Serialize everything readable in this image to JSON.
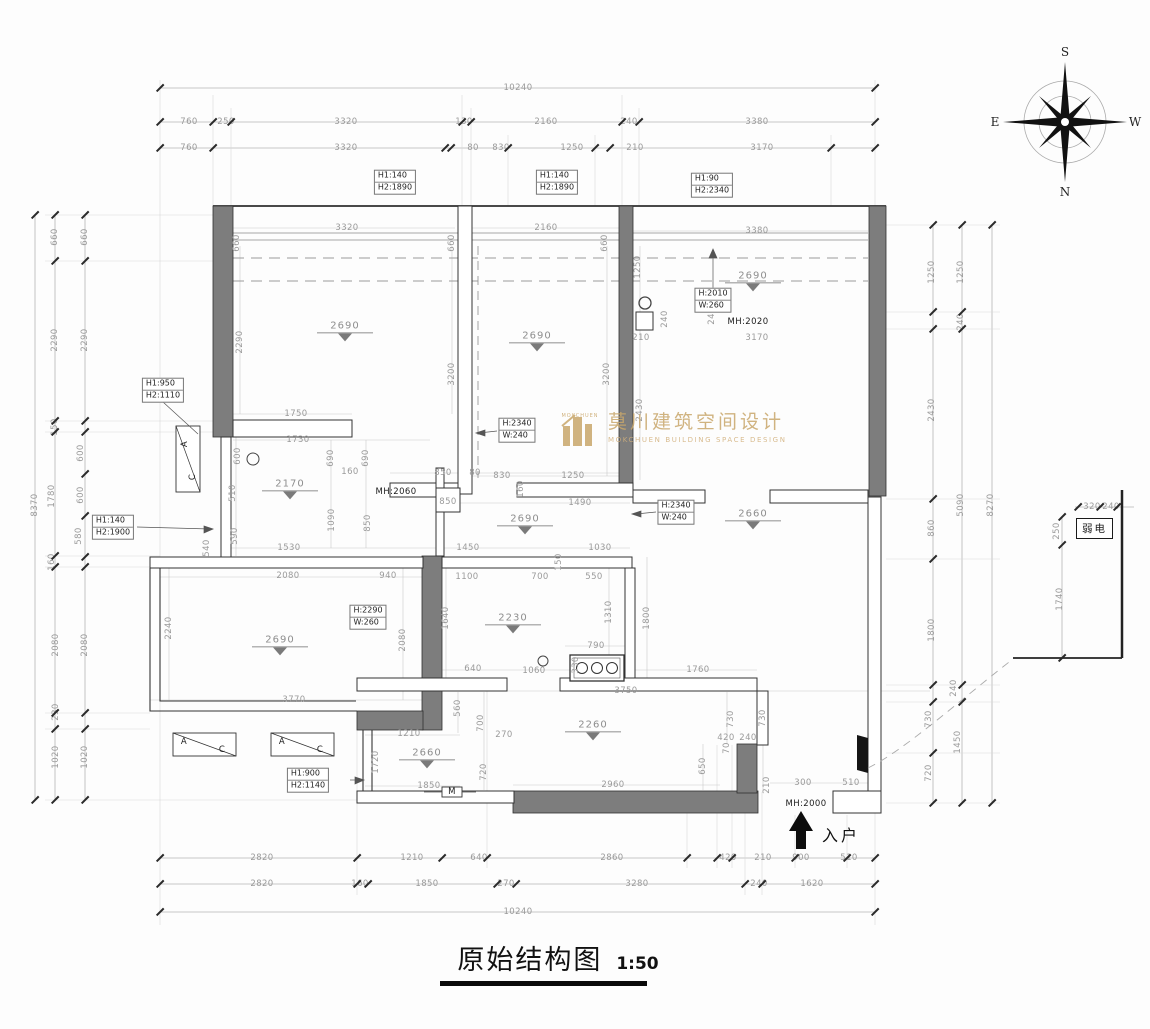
{
  "title": {
    "text": "原始结构图",
    "scale": "1:50"
  },
  "entrance": {
    "label": "入户"
  },
  "weak_current": {
    "label": "弱电"
  },
  "watermark": {
    "cn": "莫川建筑空间设计",
    "en": "MOKCHUEN BUILDING SPACE DESIGN",
    "sub": "MOKCHUEN",
    "color": "#c9a76b"
  },
  "compass": {
    "top": "S",
    "bottom": "N",
    "left": "E",
    "right": "W"
  },
  "colors": {
    "wall_fill": "#7d7d7d",
    "dim_text": "#9a9a9a",
    "line": "#2f2f2f",
    "watermark": "#c9a76b"
  },
  "levels": [
    [
      "2690",
      345,
      330
    ],
    [
      "2690",
      537,
      340
    ],
    [
      "2690",
      753,
      280
    ],
    [
      "2170",
      290,
      488
    ],
    [
      "2690",
      525,
      523
    ],
    [
      "2660",
      753,
      518
    ],
    [
      "2690",
      280,
      644
    ],
    [
      "2230",
      513,
      622
    ],
    [
      "2260",
      593,
      729
    ],
    [
      "2660",
      427,
      757
    ]
  ],
  "boxes": [
    {
      "lines": [
        "H1:140",
        "H2:1890"
      ],
      "x": 395,
      "y": 182
    },
    {
      "lines": [
        "H1:140",
        "H2:1890"
      ],
      "x": 557,
      "y": 182
    },
    {
      "lines": [
        "H1:90",
        "H2:2340"
      ],
      "x": 712,
      "y": 185
    },
    {
      "lines": [
        "H1:950",
        "H2:1110"
      ],
      "x": 163,
      "y": 390
    },
    {
      "lines": [
        "H1:140",
        "H2:1900"
      ],
      "x": 113,
      "y": 527
    },
    {
      "lines": [
        "H:2340",
        "W:240"
      ],
      "x": 517,
      "y": 430
    },
    {
      "lines": [
        "H:2010",
        "W:260"
      ],
      "x": 713,
      "y": 300
    },
    {
      "lines": [
        "H:2290",
        "W:260"
      ],
      "x": 368,
      "y": 617
    },
    {
      "lines": [
        "H:2340",
        "W:240"
      ],
      "x": 676,
      "y": 512
    },
    {
      "lines": [
        "H1:900",
        "H2:1140"
      ],
      "x": 308,
      "y": 780
    }
  ],
  "labels": [
    [
      "10240",
      518,
      88
    ],
    [
      "760",
      189,
      122
    ],
    [
      "250",
      226,
      122
    ],
    [
      "3320",
      346,
      122
    ],
    [
      "130",
      464,
      122
    ],
    [
      "2160",
      546,
      122
    ],
    [
      "240",
      629,
      122
    ],
    [
      "3380",
      757,
      122
    ],
    [
      "760",
      189,
      148
    ],
    [
      "3320",
      346,
      148
    ],
    [
      "80",
      473,
      148
    ],
    [
      "830",
      501,
      148
    ],
    [
      "1250",
      572,
      148
    ],
    [
      "210",
      635,
      148
    ],
    [
      "3170",
      762,
      148
    ],
    [
      "2820",
      262,
      858
    ],
    [
      "1210",
      412,
      858
    ],
    [
      "640",
      479,
      858
    ],
    [
      "2860",
      612,
      858
    ],
    [
      "420",
      728,
      858
    ],
    [
      "210",
      763,
      858
    ],
    [
      "900",
      801,
      858
    ],
    [
      "510",
      849,
      858
    ],
    [
      "2820",
      262,
      884
    ],
    [
      "160",
      360,
      884
    ],
    [
      "1850",
      427,
      884
    ],
    [
      "270",
      506,
      884
    ],
    [
      "3280",
      637,
      884
    ],
    [
      "240",
      759,
      884
    ],
    [
      "1620",
      812,
      884
    ],
    [
      "10240",
      518,
      912
    ],
    [
      "660",
      55,
      237,
      1
    ],
    [
      "2290",
      55,
      340,
      1
    ],
    [
      "150",
      55,
      427,
      1
    ],
    [
      "1780",
      52,
      496,
      1
    ],
    [
      "160",
      52,
      562,
      1
    ],
    [
      "2080",
      56,
      645,
      1
    ],
    [
      "230",
      56,
      712,
      1
    ],
    [
      "1020",
      56,
      757,
      1
    ],
    [
      "660",
      85,
      237,
      1
    ],
    [
      "2290",
      85,
      340,
      1
    ],
    [
      "600",
      81,
      453,
      1
    ],
    [
      "600",
      81,
      495,
      1
    ],
    [
      "580",
      79,
      536,
      1
    ],
    [
      "2080",
      85,
      645,
      1
    ],
    [
      "1020",
      85,
      757,
      1
    ],
    [
      "8370",
      35,
      505,
      1
    ],
    [
      "1250",
      932,
      272,
      1
    ],
    [
      "2430",
      932,
      410,
      1
    ],
    [
      "860",
      932,
      528,
      1
    ],
    [
      "1800",
      932,
      630,
      1
    ],
    [
      "730",
      929,
      719,
      1
    ],
    [
      "720",
      929,
      773,
      1
    ],
    [
      "1250",
      961,
      272,
      1
    ],
    [
      "240",
      961,
      322,
      1
    ],
    [
      "5090",
      961,
      505,
      1
    ],
    [
      "240",
      954,
      688,
      1
    ],
    [
      "1450",
      958,
      742,
      1
    ],
    [
      "8270",
      991,
      505,
      1
    ],
    [
      "320",
      1092,
      507
    ],
    [
      "240",
      1111,
      507
    ],
    [
      "250",
      1057,
      531,
      1
    ],
    [
      "1740",
      1060,
      599,
      1
    ],
    [
      "3320",
      347,
      228
    ],
    [
      "660",
      237,
      243,
      1
    ],
    [
      "660",
      452,
      243,
      1
    ],
    [
      "2290",
      240,
      342,
      1
    ],
    [
      "3200",
      452,
      374,
      1
    ],
    [
      "1750",
      296,
      414
    ],
    [
      "1730",
      298,
      440
    ],
    [
      "2160",
      546,
      228
    ],
    [
      "660",
      605,
      243,
      1
    ],
    [
      "3200",
      607,
      374,
      1
    ],
    [
      "830",
      502,
      476
    ],
    [
      "1250",
      573,
      476
    ],
    [
      "160",
      521,
      489,
      1
    ],
    [
      "1490",
      580,
      503
    ],
    [
      "1250",
      638,
      267,
      1
    ],
    [
      "240",
      665,
      319,
      1
    ],
    [
      "210",
      641,
      338
    ],
    [
      "2430",
      640,
      410,
      1
    ],
    [
      "3380",
      757,
      231
    ],
    [
      "3170",
      757,
      338
    ],
    [
      "240",
      712,
      316,
      1
    ],
    [
      "MH:2020",
      748,
      322,
      0,
      1
    ],
    [
      "MH:2060",
      396,
      492,
      0,
      1
    ],
    [
      "MH:2000",
      806,
      804,
      0,
      1
    ],
    [
      "600",
      238,
      456,
      1
    ],
    [
      "510",
      233,
      493,
      1
    ],
    [
      "590",
      235,
      536,
      1
    ],
    [
      "690",
      331,
      458,
      1
    ],
    [
      "690",
      366,
      458,
      1
    ],
    [
      "160",
      350,
      472
    ],
    [
      "1090",
      332,
      520,
      1
    ],
    [
      "850",
      368,
      523,
      1
    ],
    [
      "1530",
      289,
      548
    ],
    [
      "540",
      207,
      548,
      1
    ],
    [
      "850",
      443,
      473
    ],
    [
      "80",
      475,
      473
    ],
    [
      "850",
      448,
      502
    ],
    [
      "1450",
      468,
      548
    ],
    [
      "1030",
      600,
      548
    ],
    [
      "1100",
      467,
      577
    ],
    [
      "700",
      540,
      577
    ],
    [
      "550",
      594,
      577
    ],
    [
      "150",
      559,
      562,
      1
    ],
    [
      "2080",
      288,
      576
    ],
    [
      "940",
      388,
      576
    ],
    [
      "2240",
      169,
      628,
      1
    ],
    [
      "2080",
      403,
      640,
      1
    ],
    [
      "1640",
      446,
      618,
      1
    ],
    [
      "3770",
      294,
      700
    ],
    [
      "1210",
      409,
      734
    ],
    [
      "1720",
      376,
      762,
      1
    ],
    [
      "1850",
      429,
      786
    ],
    [
      "640",
      473,
      669
    ],
    [
      "1060",
      534,
      671
    ],
    [
      "330",
      576,
      665,
      1
    ],
    [
      "790",
      596,
      646
    ],
    [
      "1310",
      609,
      612,
      1
    ],
    [
      "1800",
      647,
      618,
      1
    ],
    [
      "3750",
      626,
      691
    ],
    [
      "1760",
      698,
      670
    ],
    [
      "2960",
      613,
      785
    ],
    [
      "270",
      504,
      735
    ],
    [
      "560",
      458,
      708,
      1
    ],
    [
      "700",
      481,
      723,
      1
    ],
    [
      "720",
      484,
      772,
      1
    ],
    [
      "420",
      726,
      738
    ],
    [
      "240",
      748,
      738
    ],
    [
      "650",
      703,
      766,
      1
    ],
    [
      "730",
      731,
      719,
      1
    ],
    [
      "730",
      763,
      718,
      1
    ],
    [
      "210",
      767,
      785,
      1
    ],
    [
      "300",
      803,
      783
    ],
    [
      "510",
      851,
      783
    ],
    [
      "70",
      727,
      748,
      1
    ],
    [
      "A",
      184,
      742,
      0,
      1
    ],
    [
      "C",
      222,
      750,
      0,
      1
    ],
    [
      "A",
      282,
      742,
      0,
      1
    ],
    [
      "C",
      320,
      750,
      0,
      1
    ],
    [
      "A",
      185,
      444,
      1,
      1
    ],
    [
      "C",
      193,
      477,
      1,
      1
    ],
    [
      "M",
      452,
      792,
      0,
      1
    ]
  ],
  "chains": [
    {
      "o": "h",
      "p": 88,
      "t": [
        160,
        875
      ]
    },
    {
      "o": "h",
      "p": 122,
      "t": [
        160,
        213,
        231,
        462,
        471,
        622,
        639,
        875
      ]
    },
    {
      "o": "h",
      "p": 148,
      "t": [
        160,
        213,
        445,
        451,
        508,
        595,
        610,
        831,
        875
      ]
    },
    {
      "o": "h",
      "p": 858,
      "t": [
        160,
        357,
        442,
        487,
        687,
        717,
        732,
        795,
        847,
        875
      ]
    },
    {
      "o": "h",
      "p": 884,
      "t": [
        160,
        357,
        368,
        497,
        516,
        745,
        762,
        875
      ]
    },
    {
      "o": "h",
      "p": 912,
      "t": [
        160,
        875
      ]
    },
    {
      "o": "v",
      "p": 55,
      "t": [
        215,
        261,
        421,
        432,
        556,
        567,
        713,
        729,
        800
      ]
    },
    {
      "o": "v",
      "p": 85,
      "t": [
        215,
        261,
        421,
        432,
        474,
        516,
        557,
        567,
        713,
        729,
        800
      ]
    },
    {
      "o": "v",
      "p": 35,
      "t": [
        215,
        800
      ]
    },
    {
      "o": "v",
      "p": 933,
      "t": [
        225,
        312,
        329,
        499,
        559,
        685,
        702,
        753,
        803
      ]
    },
    {
      "o": "v",
      "p": 962,
      "t": [
        225,
        312,
        329,
        685,
        702,
        803
      ]
    },
    {
      "o": "v",
      "p": 992,
      "t": [
        225,
        803
      ]
    },
    {
      "o": "h",
      "p": 507,
      "t": [
        1078,
        1100,
        1117
      ]
    },
    {
      "o": "v",
      "p": 1062,
      "t": [
        517,
        545,
        658
      ]
    }
  ]
}
